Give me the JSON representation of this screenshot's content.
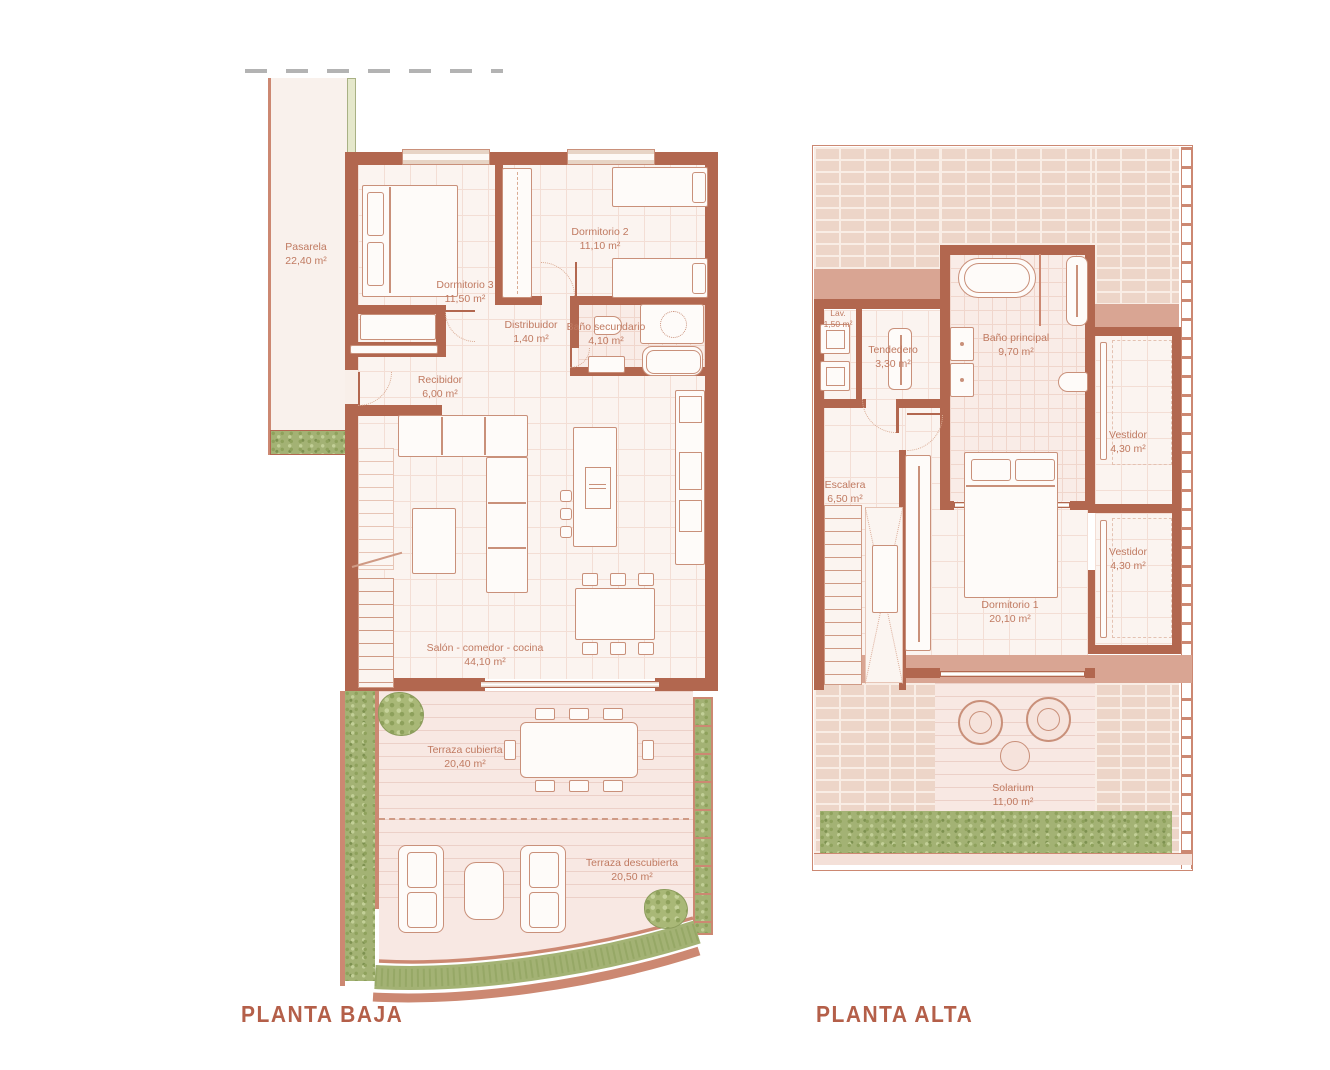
{
  "palette": {
    "wall": "#b2674f",
    "wall_light": "#cc8872",
    "floor": "#fbf4f0",
    "deck": "#f8e8e3",
    "brick": "#edd5c8",
    "accent_band": "#d9a593",
    "hedge_green": "#a3b274",
    "label_text": "#c07a61",
    "title_text": "#b45f49"
  },
  "plans": [
    {
      "id": "planta-baja",
      "title": "PLANTA BAJA",
      "rooms": [
        {
          "name": "Pasarela",
          "area": "22,40 m²"
        },
        {
          "name": "Dormitorio 3",
          "area": "11,50 m²"
        },
        {
          "name": "Dormitorio 2",
          "area": "11,10 m²"
        },
        {
          "name": "Distribuidor",
          "area": "1,40 m²"
        },
        {
          "name": "Baño secundario",
          "area": "4,10 m²"
        },
        {
          "name": "Recibidor",
          "area": "6,00 m²"
        },
        {
          "name": "Salón - comedor - cocina",
          "area": "44,10 m²"
        },
        {
          "name": "Terraza cubierta",
          "area": "20,40 m²"
        },
        {
          "name": "Terraza descubierta",
          "area": "20,50 m²"
        }
      ]
    },
    {
      "id": "planta-alta",
      "title": "PLANTA ALTA",
      "rooms": [
        {
          "name": "Lav.",
          "area": "1,50 m²"
        },
        {
          "name": "Tendedero",
          "area": "3,30 m²"
        },
        {
          "name": "Baño principal",
          "area": "9,70 m²"
        },
        {
          "name": "Vestidor",
          "area": "4,30 m²"
        },
        {
          "name": "Vestidor",
          "area": "4,30 m²"
        },
        {
          "name": "Escalera",
          "area": "6,50 m²"
        },
        {
          "name": "Dormitorio 1",
          "area": "20,10 m²"
        },
        {
          "name": "Solarium",
          "area": "11,00 m²"
        }
      ]
    }
  ]
}
